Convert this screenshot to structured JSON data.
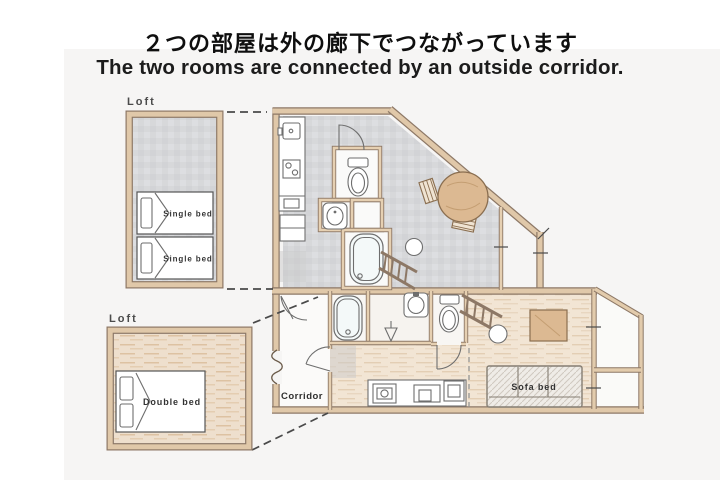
{
  "header": {
    "title_jp": "２つの部屋は外の廊下でつながっています",
    "title_en": "The two rooms are connected by an outside corridor."
  },
  "plan": {
    "upper_loft": {
      "label": "Loft",
      "beds": [
        "Single bed",
        "Single bed"
      ]
    },
    "lower_loft": {
      "label": "Loft",
      "bed": "Double bed"
    },
    "main": {
      "corridor_label": "Corridor",
      "sofa_label": "Sofa bed"
    }
  },
  "colors": {
    "wood": "#e0c8a9",
    "wood_edge": "#8d7866",
    "tile_floor": "#d8d8db",
    "plank_floor": "#f2e5d4",
    "loft_plank_floor": "#eedfcd",
    "background_panel": "#f6f5f4",
    "title_text": "#0f0f0f"
  }
}
